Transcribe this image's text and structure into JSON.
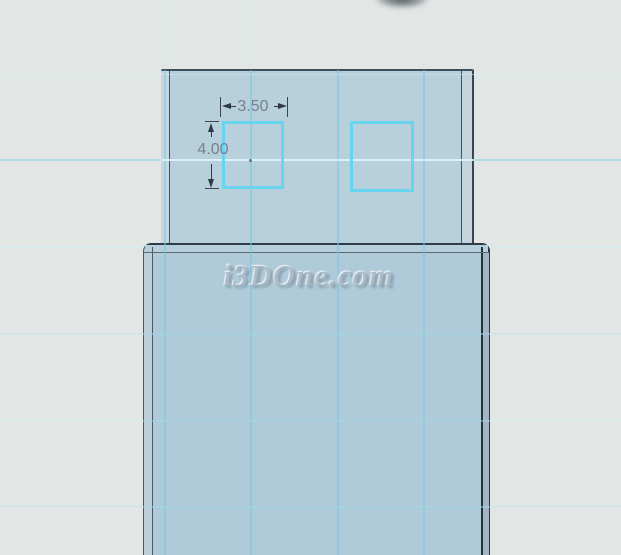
{
  "viewport": {
    "type": "cad-3d-viewport",
    "background_color": "#E2E7E6",
    "watermark_text": "i3DOne.com"
  },
  "model": {
    "part_name": "usb-connector-block",
    "shield_fill": "#B8CFDC",
    "body_fill": "#AFCAD8",
    "edge_color": "#2E3D47"
  },
  "sketch": {
    "stroke_color": "#68D5F0",
    "dim_width": {
      "label": "3.50"
    },
    "dim_height": {
      "label": "4.00"
    }
  },
  "grid": {
    "bg_vertical_x": [
      77,
      164,
      250,
      337,
      423,
      509,
      595
    ],
    "bg_vertical_color": "#D4E7EF",
    "bg_horizontal": [
      {
        "y": 74,
        "color": "#D8EAF1",
        "w": 1
      },
      {
        "y": 159,
        "color": "#B4DAE7",
        "w": 2
      },
      {
        "y": 247,
        "color": "#D8EAF1",
        "w": 1
      },
      {
        "y": 333,
        "color": "#C8E3EE",
        "w": 1
      },
      {
        "y": 420,
        "color": "#D8EAF1",
        "w": 1
      },
      {
        "y": 506,
        "color": "#C8E3EE",
        "w": 1
      }
    ],
    "model_vertical_x": [
      164,
      250,
      337,
      423
    ],
    "model_vertical_color": "rgba(120,198,228,0.55)",
    "model_horizontal": [
      {
        "y": 74,
        "color": "rgba(205,232,243,0.55)",
        "w": 1
      },
      {
        "y": 159,
        "color": "rgba(225,244,250,0.85)",
        "w": 2
      },
      {
        "y": 333,
        "color": "rgba(160,215,235,0.50)",
        "w": 1.5
      },
      {
        "y": 420,
        "color": "rgba(160,215,235,0.45)",
        "w": 1.5
      },
      {
        "y": 506,
        "color": "rgba(160,215,235,0.50)",
        "w": 1.5
      }
    ]
  }
}
